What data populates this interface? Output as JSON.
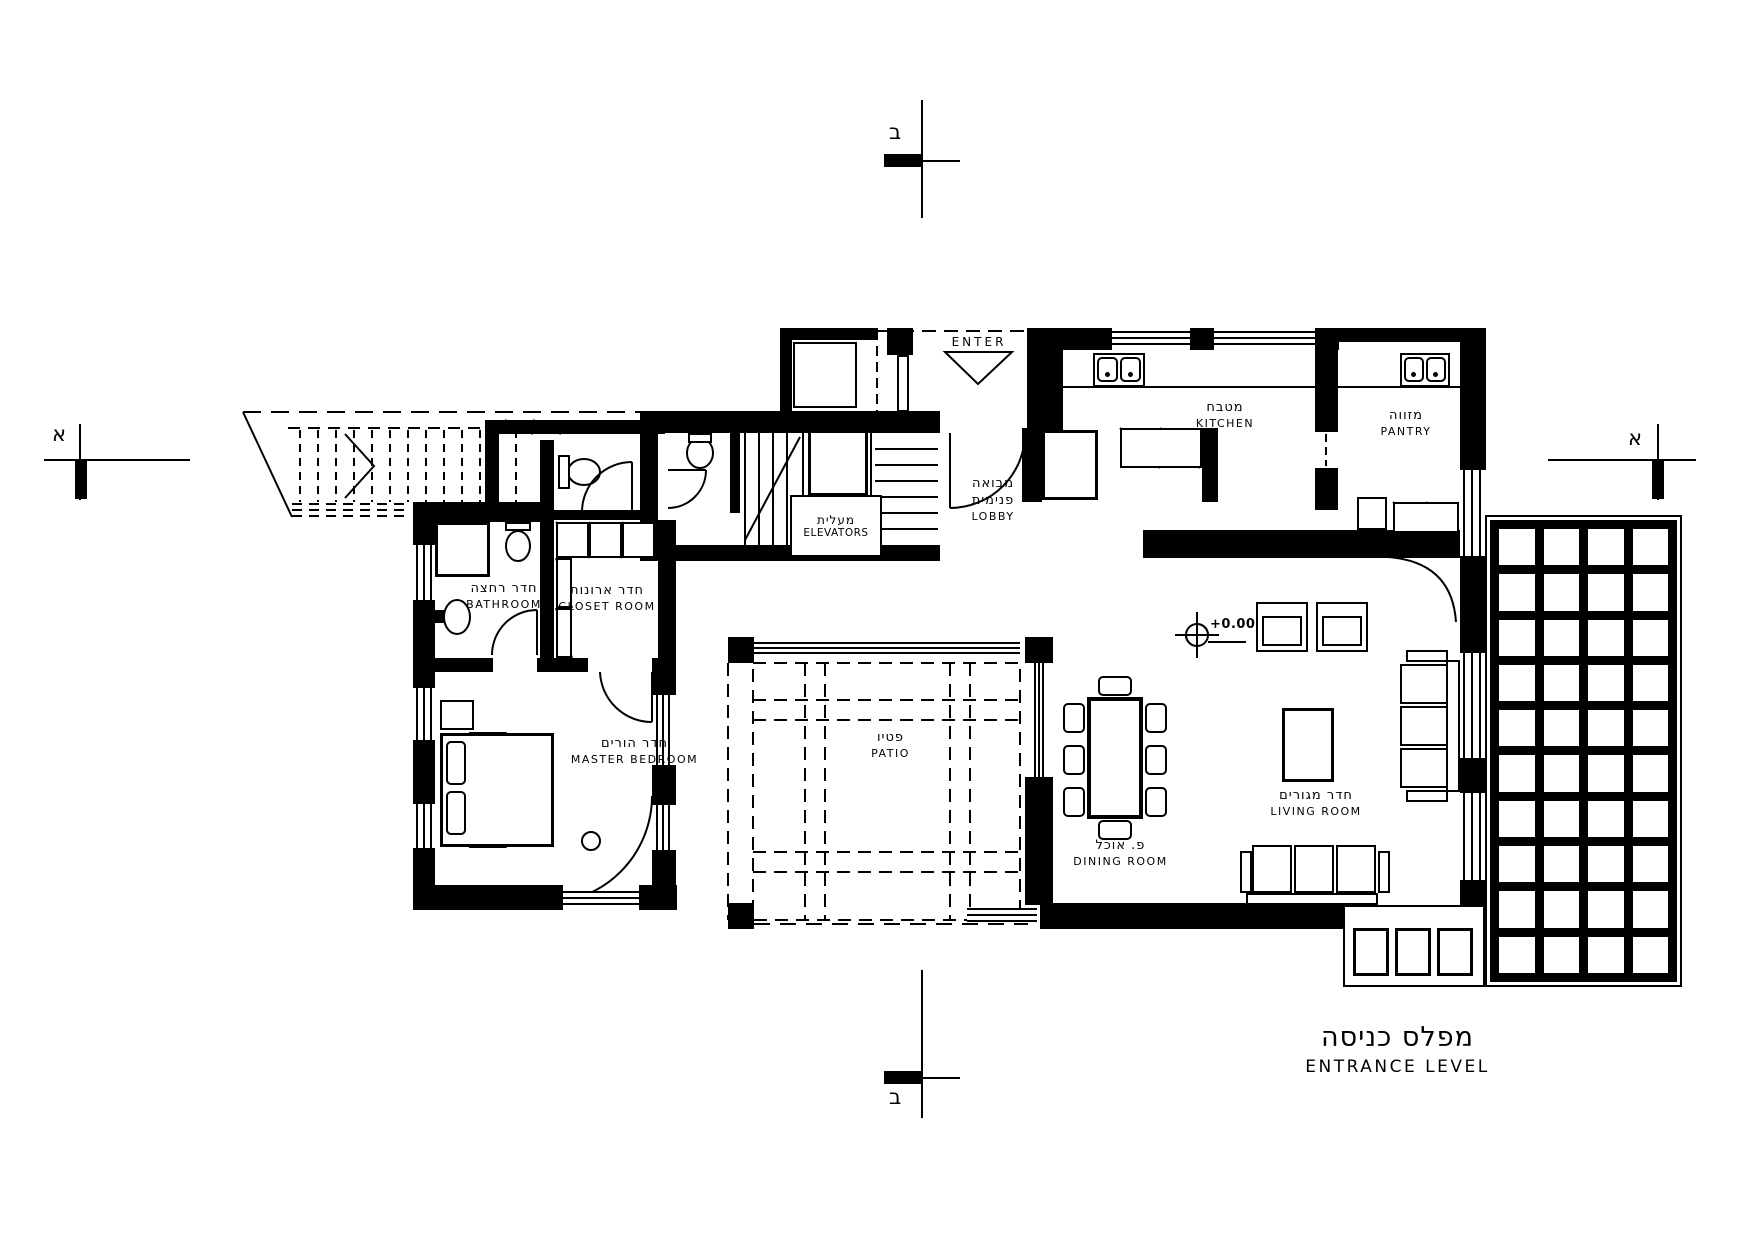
{
  "title": {
    "he": "מפלס כניסה",
    "en": "ENTRANCE LEVEL"
  },
  "annotations": {
    "enter": "ENTER",
    "level": "+0.00"
  },
  "markers": {
    "top": "ב",
    "bottom": "ב",
    "left": "א",
    "right": "א"
  },
  "rooms": {
    "kitchen": {
      "he": "מטבח",
      "en": "KITCHEN"
    },
    "pantry": {
      "he": "מזווה",
      "en": "PANTRY"
    },
    "lobby": {
      "he1": "מבואה",
      "he2": "פנימית",
      "en": "LOBBY"
    },
    "elevators": {
      "he": "מעלית",
      "en": "ELEVATORS"
    },
    "bathroom": {
      "he": "חדר רחצה",
      "en": "BATHROOM"
    },
    "closet": {
      "he": "חדר ארונות",
      "en": "CLOSET ROOM"
    },
    "master_bedroom": {
      "he": "חדר הורים",
      "en": "MASTER BEDROOM"
    },
    "patio": {
      "he": "פטיו",
      "en": "PATIO"
    },
    "dining": {
      "he": "פ. אוכל",
      "en": "DINING ROOM"
    },
    "living": {
      "he": "חדר מגורים",
      "en": "LIVING ROOM"
    }
  },
  "colors": {
    "ink": "#000000",
    "paper": "#ffffff"
  }
}
